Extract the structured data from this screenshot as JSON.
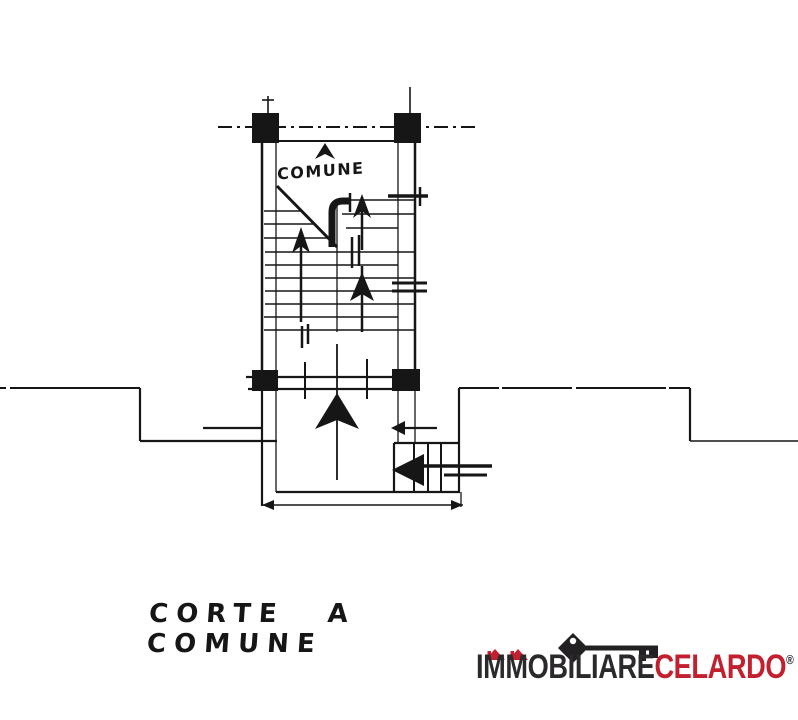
{
  "page": {
    "background": "#ffffff",
    "ink_color": "#161616",
    "type": "scanned floor plan"
  },
  "plan": {
    "stairwell_label": "COMUNE",
    "caption": "CORTE A COMUNE"
  },
  "logo": {
    "primary": "IMMOBILIARE",
    "accent": "CELARDO",
    "registered": "®",
    "primary_color": "#2b292c",
    "accent_color": "#c2202e",
    "key_color": "#232023",
    "roof_color": "#c2202e"
  },
  "icons": {
    "key": "key-icon",
    "roofs": "house-roofs-icon"
  }
}
